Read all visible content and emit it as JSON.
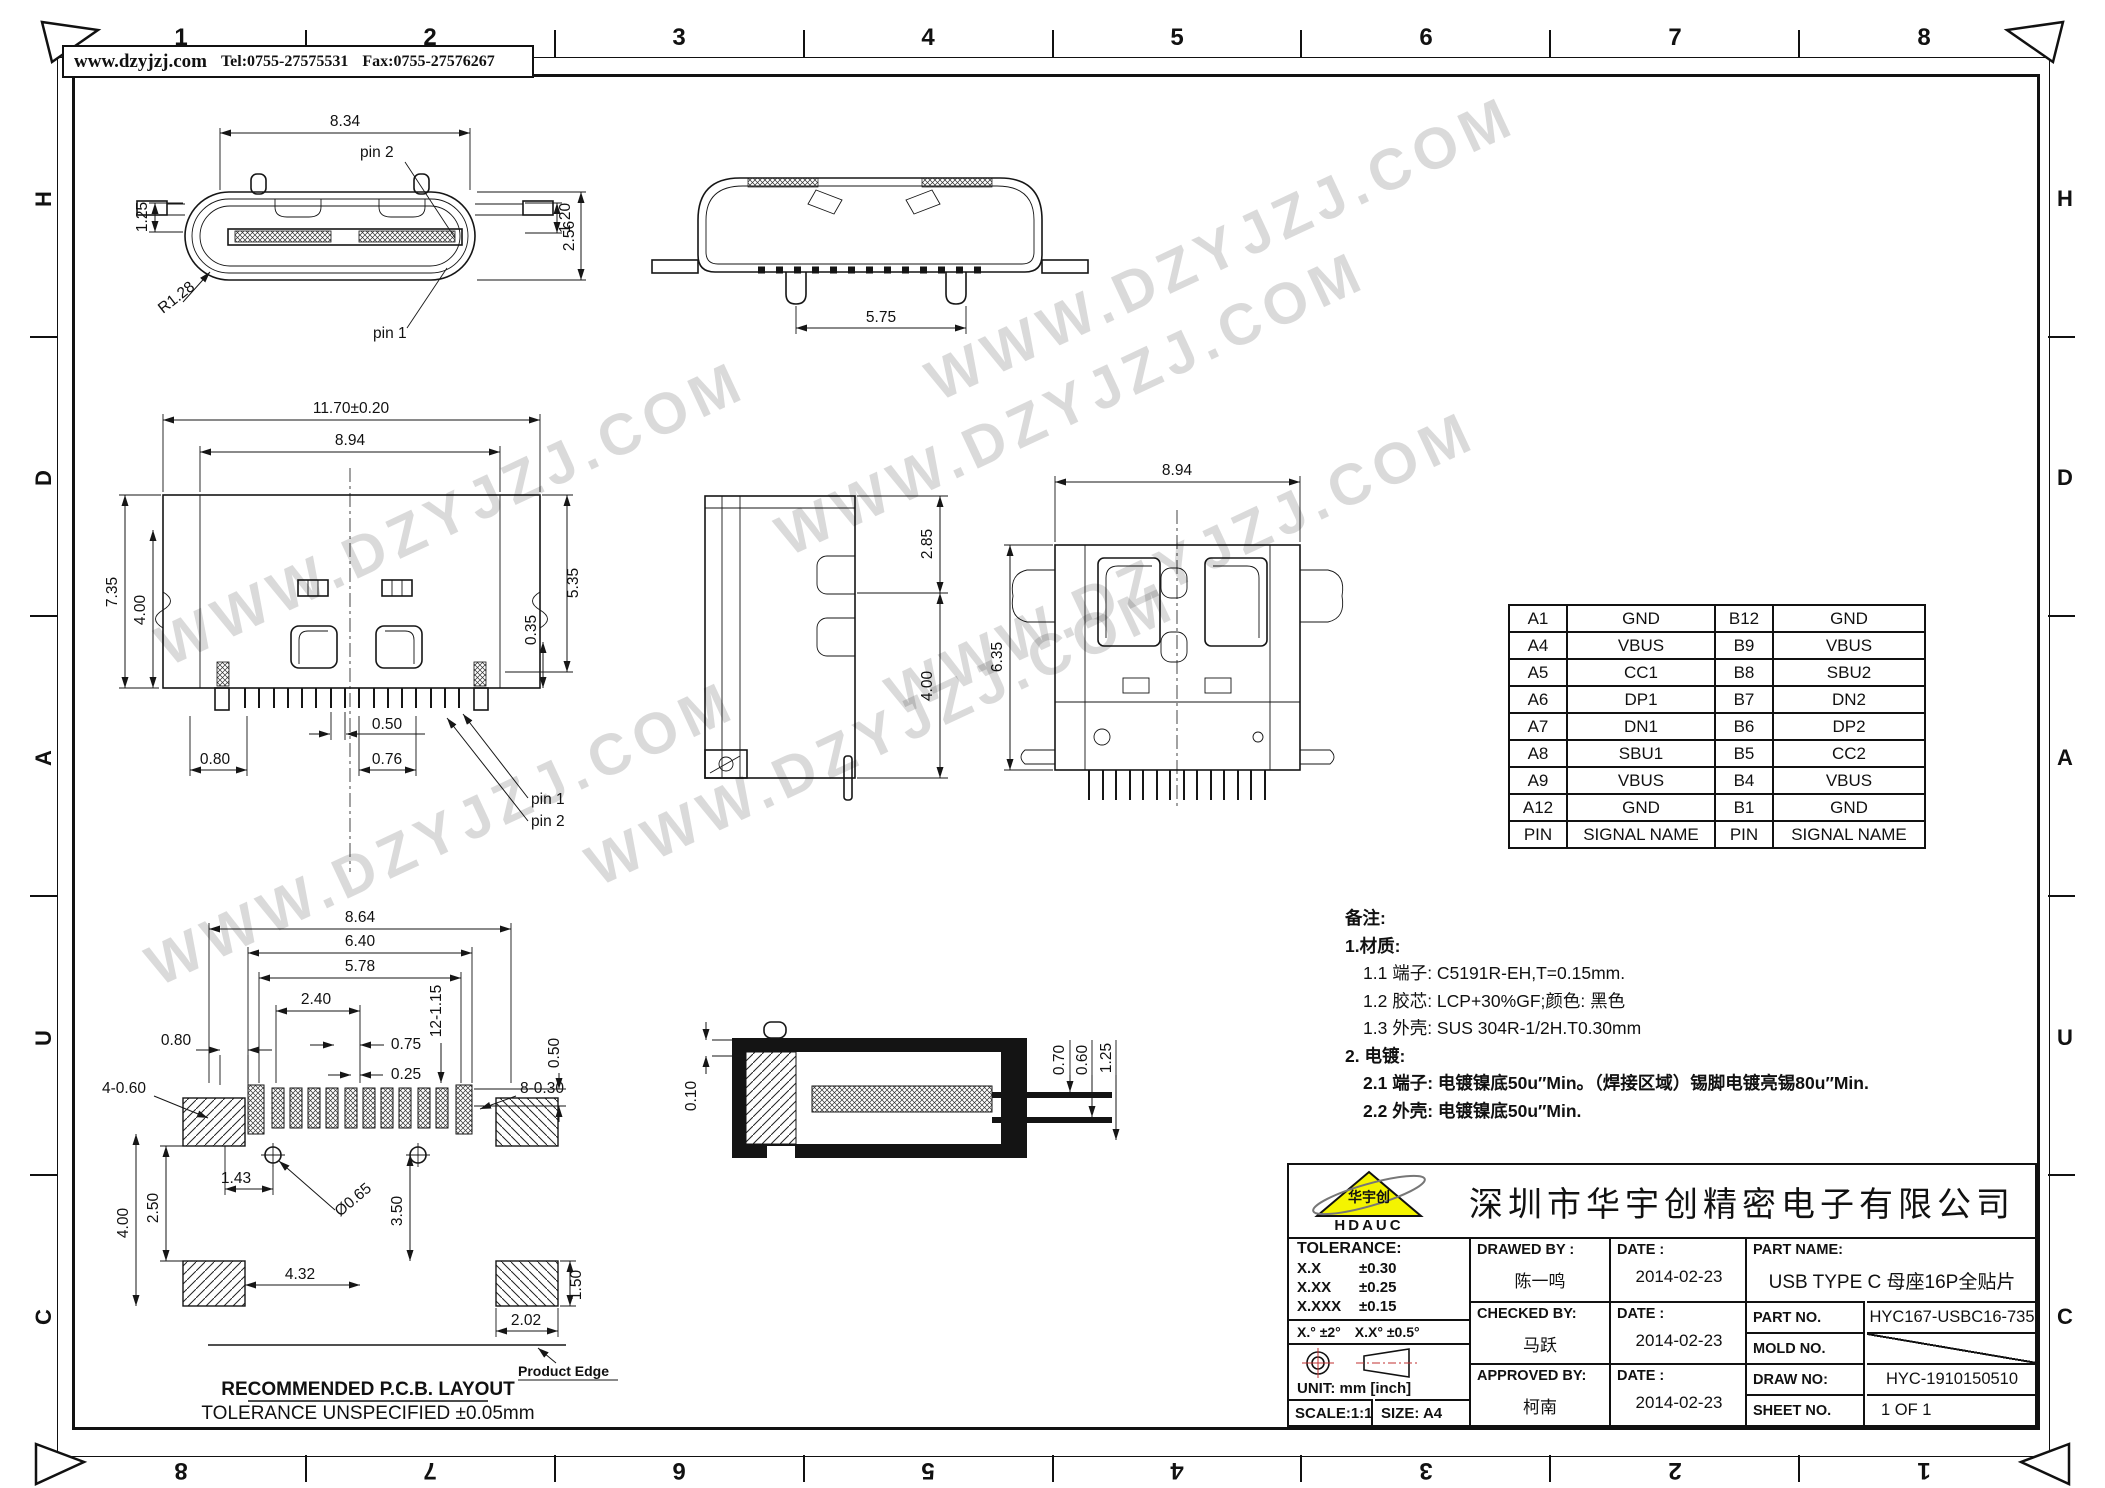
{
  "frame": {
    "zone_numbers": [
      "1",
      "2",
      "3",
      "4",
      "5",
      "6",
      "7",
      "8"
    ],
    "zone_letters": [
      "H",
      "D",
      "A",
      "U",
      "C"
    ]
  },
  "header": {
    "website": "www.dzyjzj.com",
    "tel": "Tel:0755-27575531",
    "fax": "Fax:0755-27576267"
  },
  "watermark": {
    "text": "WWW.DZYJZJ.COM"
  },
  "views": {
    "front": {
      "dim_width": "8.34",
      "dim_left_h": "1.25",
      "dim_right_h": "1.20",
      "dim_height": "2.56",
      "dim_radius": "R1.28",
      "label_pin1": "pin 1",
      "label_pin2": "pin 2"
    },
    "rear": {
      "dim_width": "5.75"
    },
    "elevation": {
      "dim_overall": "11.70±0.20",
      "dim_shell": "8.94",
      "dim_h1": "7.35",
      "dim_h2": "4.00",
      "dim_h3": "5.35",
      "dim_pin_h": "0.35",
      "dim_pitch": "0.50",
      "dim_c1": "0.76",
      "dim_c2": "0.80",
      "label_pin1": "pin 1",
      "label_pin2": "pin 2"
    },
    "side": {
      "dim_top": "2.85",
      "dim_bottom": "4.00"
    },
    "top": {
      "dim_width": "8.94",
      "dim_depth": "6.35"
    },
    "pcb": {
      "dim_w1": "8.64",
      "dim_w2": "6.40",
      "dim_w3": "5.78",
      "dim_w4": "2.40",
      "dim_w5": "0.75",
      "dim_w6": "0.25",
      "dim_w7": "0.80",
      "dim_hole4": "4-0.60",
      "dim_pad8": "8-0.30",
      "dim_pad12": "12-1.15",
      "dim_pad_h": "0.50",
      "dim_a": "1.43",
      "dim_dia": "Ø0.65",
      "dim_b": "2.50",
      "dim_c": "4.00",
      "dim_d": "3.50",
      "dim_e": "4.32",
      "dim_f": "1.50",
      "dim_g": "2.02",
      "label_title": "RECOMMENDED   P.C.B.  LAYOUT",
      "label_tol": "TOLERANCE  UNSPECIFIED  ±0.05mm",
      "label_edge": "Product Edge"
    },
    "section": {
      "dim_a": "0.10",
      "dim_b": "0.70",
      "dim_c": "0.60",
      "dim_d": "1.25"
    }
  },
  "pin_table": {
    "rows": [
      {
        "p1": "A1",
        "s1": "GND",
        "p2": "B12",
        "s2": "GND"
      },
      {
        "p1": "A4",
        "s1": "VBUS",
        "p2": "B9",
        "s2": "VBUS"
      },
      {
        "p1": "A5",
        "s1": "CC1",
        "p2": "B8",
        "s2": "SBU2"
      },
      {
        "p1": "A6",
        "s1": "DP1",
        "p2": "B7",
        "s2": "DN2"
      },
      {
        "p1": "A7",
        "s1": "DN1",
        "p2": "B6",
        "s2": "DP2"
      },
      {
        "p1": "A8",
        "s1": "SBU1",
        "p2": "B5",
        "s2": "CC2"
      },
      {
        "p1": "A9",
        "s1": "VBUS",
        "p2": "B4",
        "s2": "VBUS"
      },
      {
        "p1": "A12",
        "s1": "GND",
        "p2": "B1",
        "s2": "GND"
      }
    ],
    "footer": {
      "p1": "PIN",
      "s1": "SIGNAL NAME",
      "p2": "PIN",
      "s2": "SIGNAL NAME"
    }
  },
  "notes": {
    "title": "备注:",
    "l1": "1.材质:",
    "l1_1": "1.1 端子: C5191R-EH,T=0.15mm.",
    "l1_2": "1.2 胶芯: LCP+30%GF;颜色: 黑色",
    "l1_3": "1.3 外壳:  SUS 304R-1/2H.T0.30mm",
    "l2": "2. 电镀:",
    "l2_1": "2.1 端子: 电镀镍底50u″Min。（焊接区域）锡脚电镀亮锡80u″Min.",
    "l2_2": "2.2 外壳: 电镀镍底50u″Min."
  },
  "title_block": {
    "company": "深圳市华宇创精密电子有限公司",
    "logo_text": "华宇创",
    "logo_sub": "HDAUC",
    "tol_title": "TOLERANCE:",
    "tol_1l": "X.X",
    "tol_1v": "±0.30",
    "tol_2l": "X.XX",
    "tol_2v": "±0.25",
    "tol_3l": "X.XXX",
    "tol_3v": "±0.15",
    "tol_a1": "X.°  ±2°",
    "tol_a2": "X.X°  ±0.5°",
    "unit": "UNIT:  mm  [inch]",
    "scale": "SCALE:1:1",
    "size": "SIZE:  A4",
    "drawed_label": "DRAWED BY :",
    "drawed_name": "陈一鸣",
    "date_label": "DATE :",
    "drawed_date": "2014-02-23",
    "checked_label": "CHECKED BY:",
    "checked_name": "马跃",
    "checked_date": "2014-02-23",
    "approved_label": "APPROVED BY:",
    "approved_name": "柯南",
    "approved_date": "2014-02-23",
    "part_name_label": "PART NAME:",
    "part_name": "USB TYPE C 母座16P全贴片",
    "part_no_label": "PART NO.",
    "part_no": "HYC167-USBC16-735",
    "mold_no_label": "MOLD NO.",
    "draw_no_label": "DRAW NO:",
    "draw_no": "HYC-1910150510",
    "sheet_no_label": "SHEET NO.",
    "sheet_no": "1 OF 1"
  },
  "colors": {
    "line": "#111111",
    "logo_yellow": "#f4f400",
    "red_accent": "#c03030"
  }
}
